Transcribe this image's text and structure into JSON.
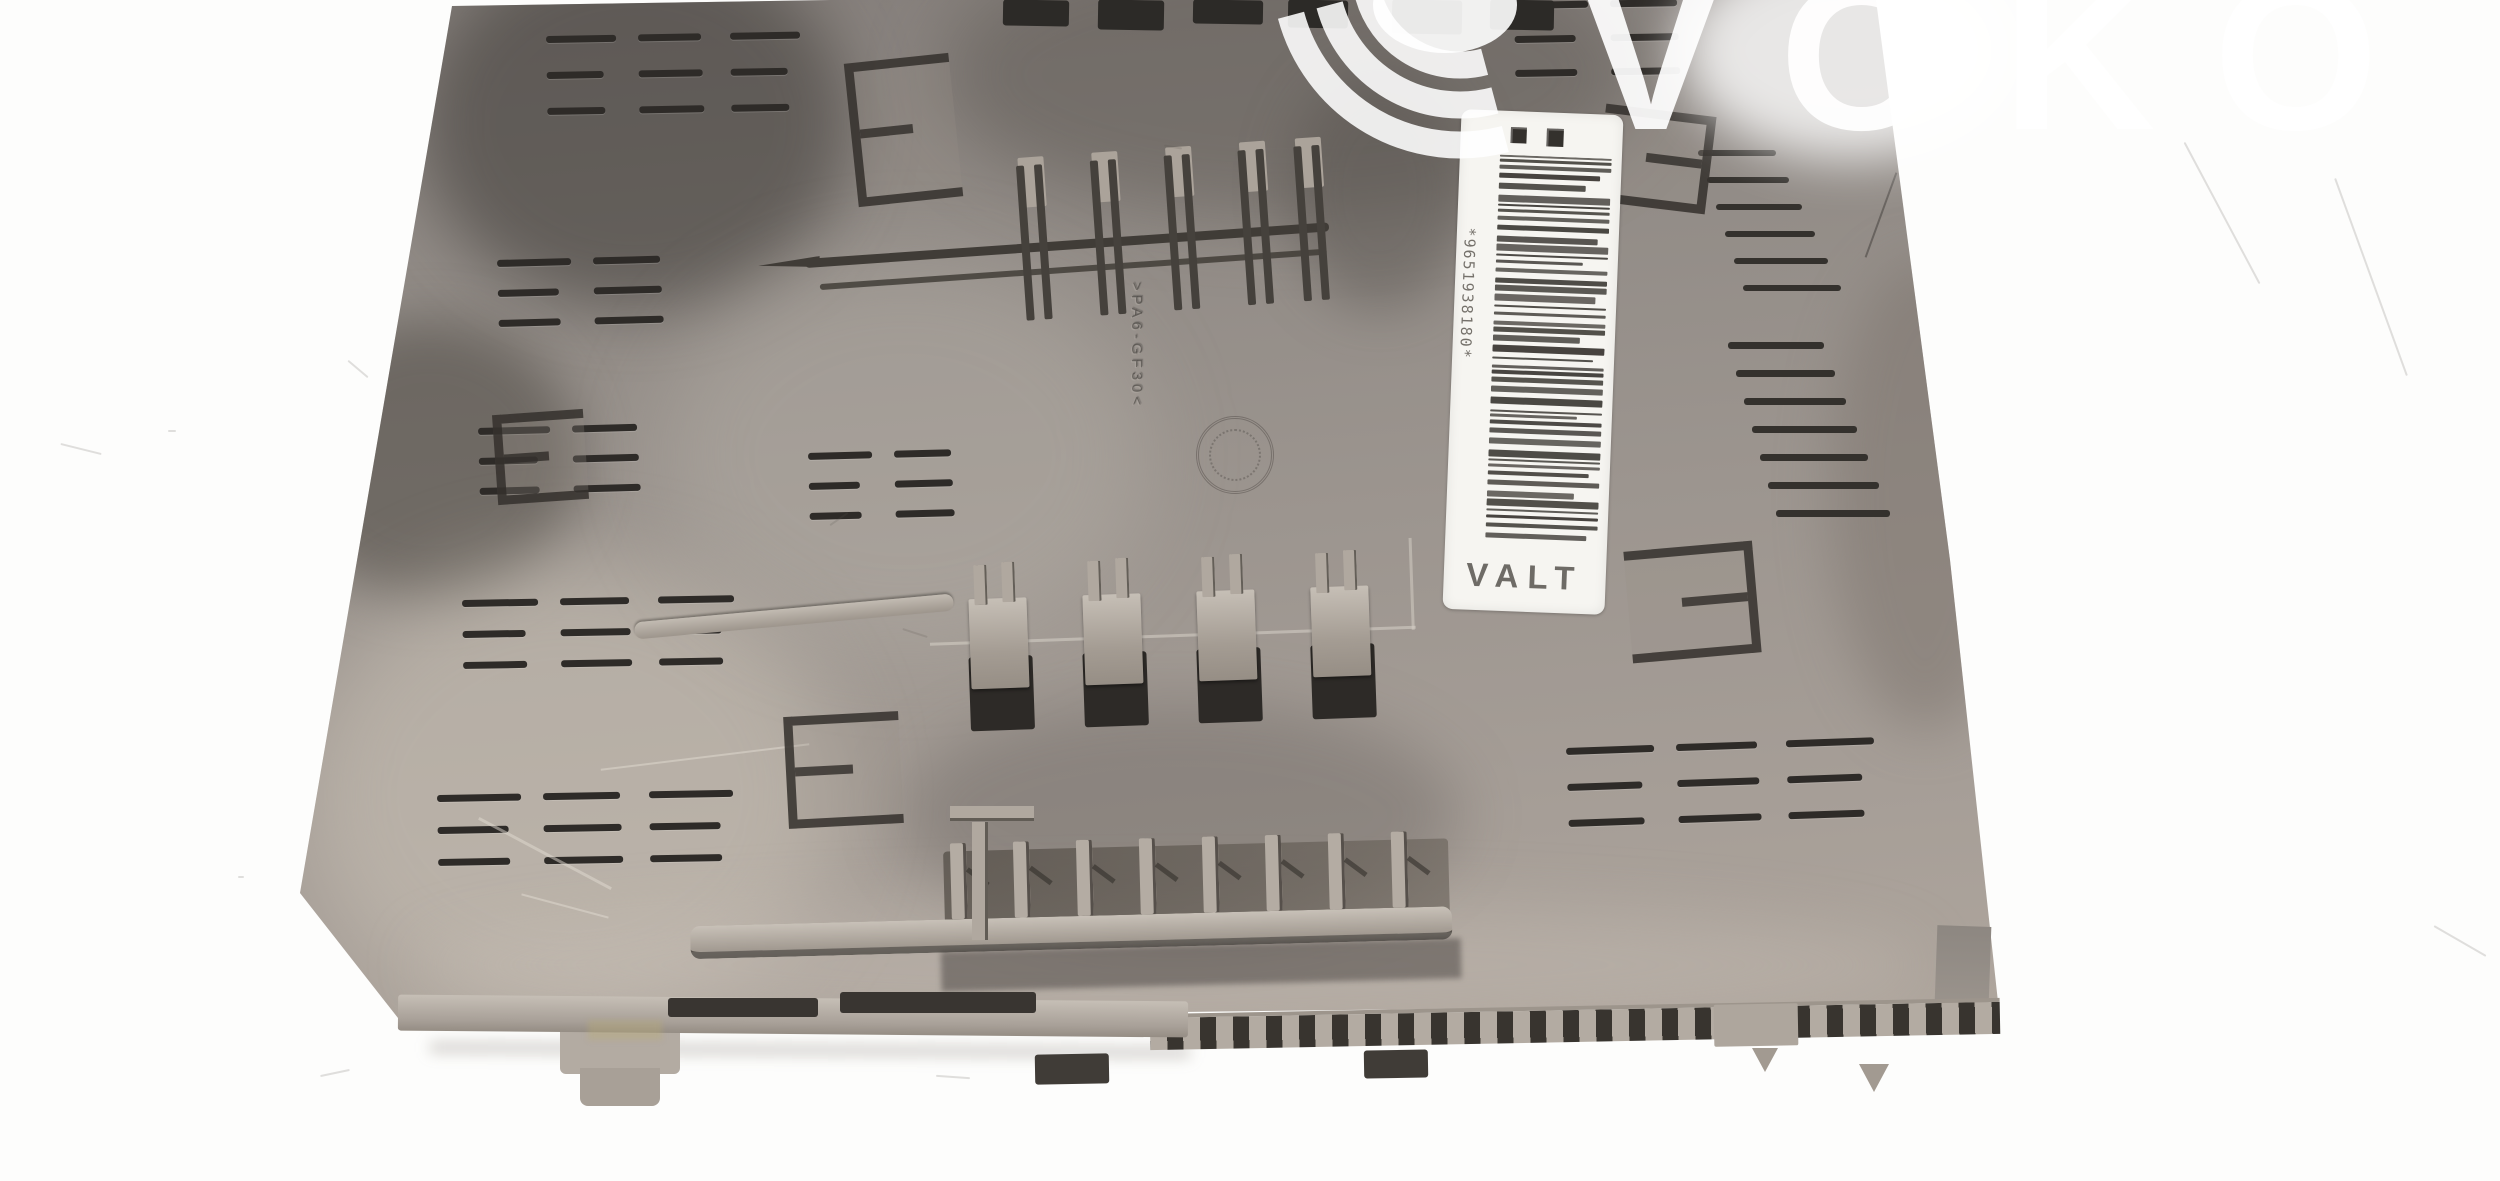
{
  "photo": {
    "background_color": "#fdfdfc"
  },
  "watermark": {
    "text": "VOKO",
    "color": "#ffffff"
  },
  "label": {
    "barcode_number": "*9651938180*",
    "product_code": "VALT",
    "background": "#f6f5f1",
    "bar_color": "#35322d",
    "text_color": "#6e6b66"
  },
  "part": {
    "embossed_mark": ">PA6-GF30<",
    "slot_color": "#2e2b28",
    "edge_band_color": "#b3aba2"
  }
}
